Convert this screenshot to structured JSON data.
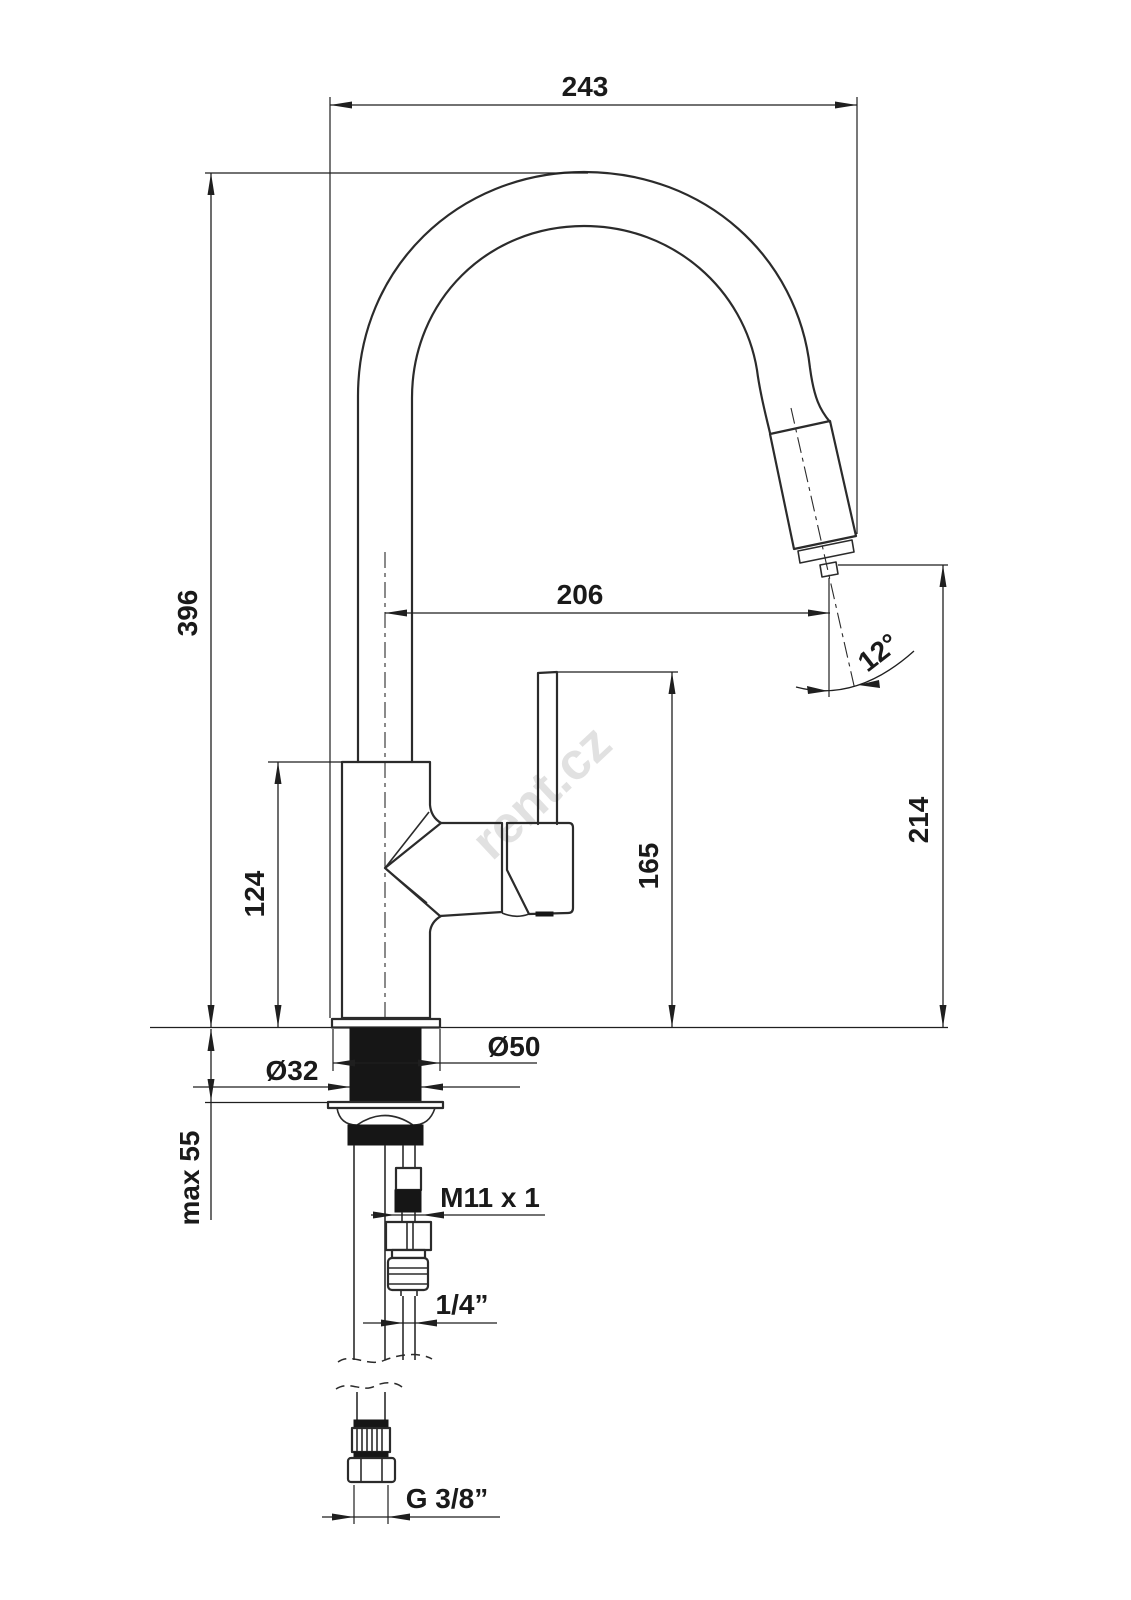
{
  "drawing": {
    "watermark": "rent.cz",
    "dimensions": {
      "overall_width": "243",
      "overall_height": "396",
      "spout_reach": "206",
      "spray_angle": "12°",
      "outlet_height": "214",
      "lever_height": "165",
      "body_height": "124",
      "base_diameter": "Ø50",
      "shank_diameter": "Ø32",
      "max_counter_thickness": "max 55",
      "hose_thread": "M11 x 1",
      "hose_diameter": "1/4”",
      "supply_thread": "G 3/8”"
    }
  }
}
